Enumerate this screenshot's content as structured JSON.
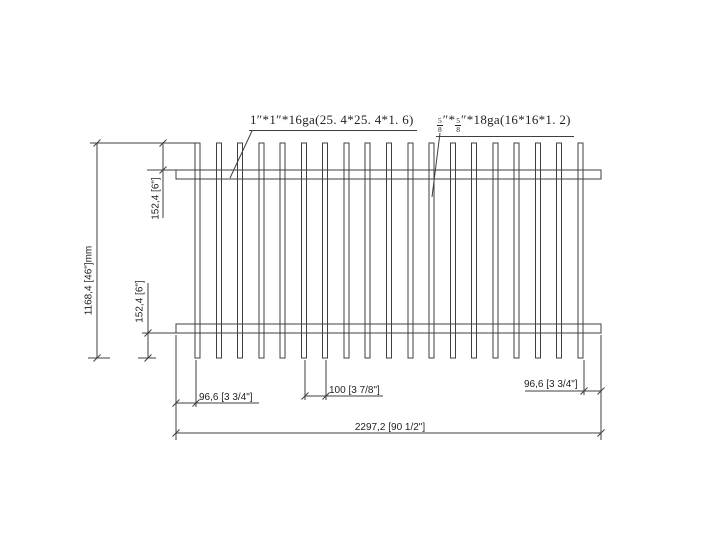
{
  "drawing": {
    "type": "fence-panel-technical-drawing",
    "callouts": {
      "rail_spec": "1″*1″*16ga(25. 4*25. 4*1. 6)",
      "picket_spec": {
        "num1": "5",
        "den1": "8",
        "mid1": "″*",
        "num2": "5",
        "den2": "8",
        "tail": "″*18ga(16*16*1. 2)"
      }
    },
    "dimensions": {
      "overall_height": "1168,4 [46\"]mm",
      "top_rail_offset": "152,4 [6\"]",
      "bottom_rail_offset": "152,4 [6\"]",
      "left_end_spacing": "96,6 [3 3/4\"]",
      "picket_spacing": "100 [3 7/8\"]",
      "right_end_spacing": "96,6 [3 3/4\"]",
      "overall_width": "2297,2 [90 1/2\"]"
    },
    "fence": {
      "picket_count": 19,
      "rail_count": 2
    },
    "colors": {
      "line": "#3f3f3f",
      "text": "#1f1f1f",
      "background": "#ffffff"
    }
  }
}
